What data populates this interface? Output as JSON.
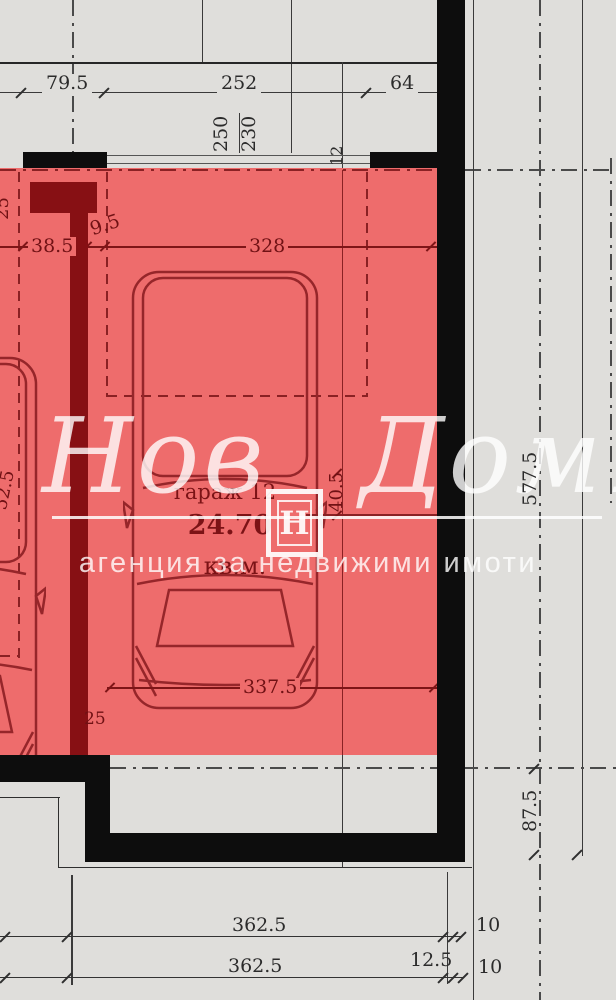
{
  "room": {
    "name": "гараж 12",
    "area": "24.70",
    "unit": "кв.м."
  },
  "dims": {
    "top": {
      "left": "79.5",
      "middle": "252",
      "right": "64"
    },
    "door": {
      "outer": "250",
      "inner": "230"
    },
    "wall_thickness": "12",
    "interior": {
      "left": "38.5",
      "pier": "9.5",
      "width": "328"
    },
    "edge": {
      "top": "25",
      "middle": "52.5"
    },
    "small_offset": "40.5",
    "depth": "337.5",
    "step": "25",
    "right": {
      "total": "577.5",
      "lower": "87.5"
    },
    "bottom": {
      "row1": "362.5",
      "row1_offset": "10",
      "row2": "362.5",
      "row2_wall": "12.5",
      "row2_offset": "10"
    }
  },
  "watermark": {
    "brand": "Нов Дом1",
    "tagline": "агенция за недвижими имоти",
    "logo_letter": "Н"
  },
  "colors": {
    "highlight_overlay": "#ee6c6c",
    "maroon_wall": "#871014",
    "plan_line_red": "#96262a",
    "black_wall": "#0d0d0d",
    "gray_line": "#3a3a3a",
    "background": "#dfdedb",
    "watermark_white": "#ffffff"
  }
}
